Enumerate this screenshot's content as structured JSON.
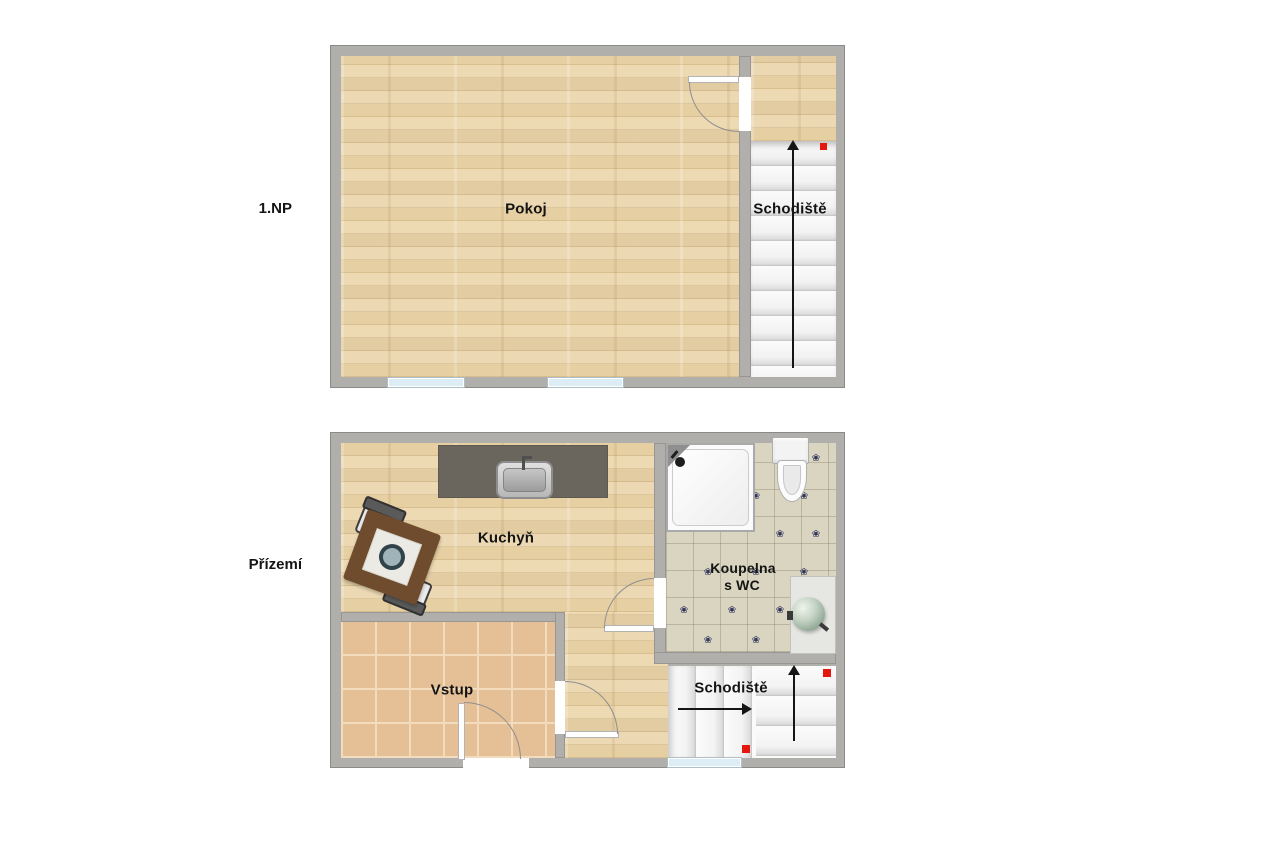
{
  "floors": [
    {
      "label": "1.NP",
      "rooms": {
        "pokoj": "Pokoj",
        "schodiste": "Schodiště"
      }
    },
    {
      "label": "Přízemí",
      "rooms": {
        "kuchyn": "Kuchyň",
        "koupelna_line1": "Koupelna",
        "koupelna_line2": "s WC",
        "vstup": "Vstup",
        "schodiste": "Schodiště"
      }
    }
  ],
  "colors": {
    "wall": "#b1afac",
    "wood_floor": "#ecd9b3",
    "entry_tile": "#e5bf96",
    "bath_tile": "#d9d5c0",
    "kitchen_counter": "#6b665d",
    "stair_tread": "#f5f5f5",
    "window_glass": "#dcedf5",
    "marker_red": "#e3170d",
    "tile_ornament": "#32355e",
    "label_text": "#141414"
  },
  "icons": {
    "tile_flower": "❀"
  }
}
